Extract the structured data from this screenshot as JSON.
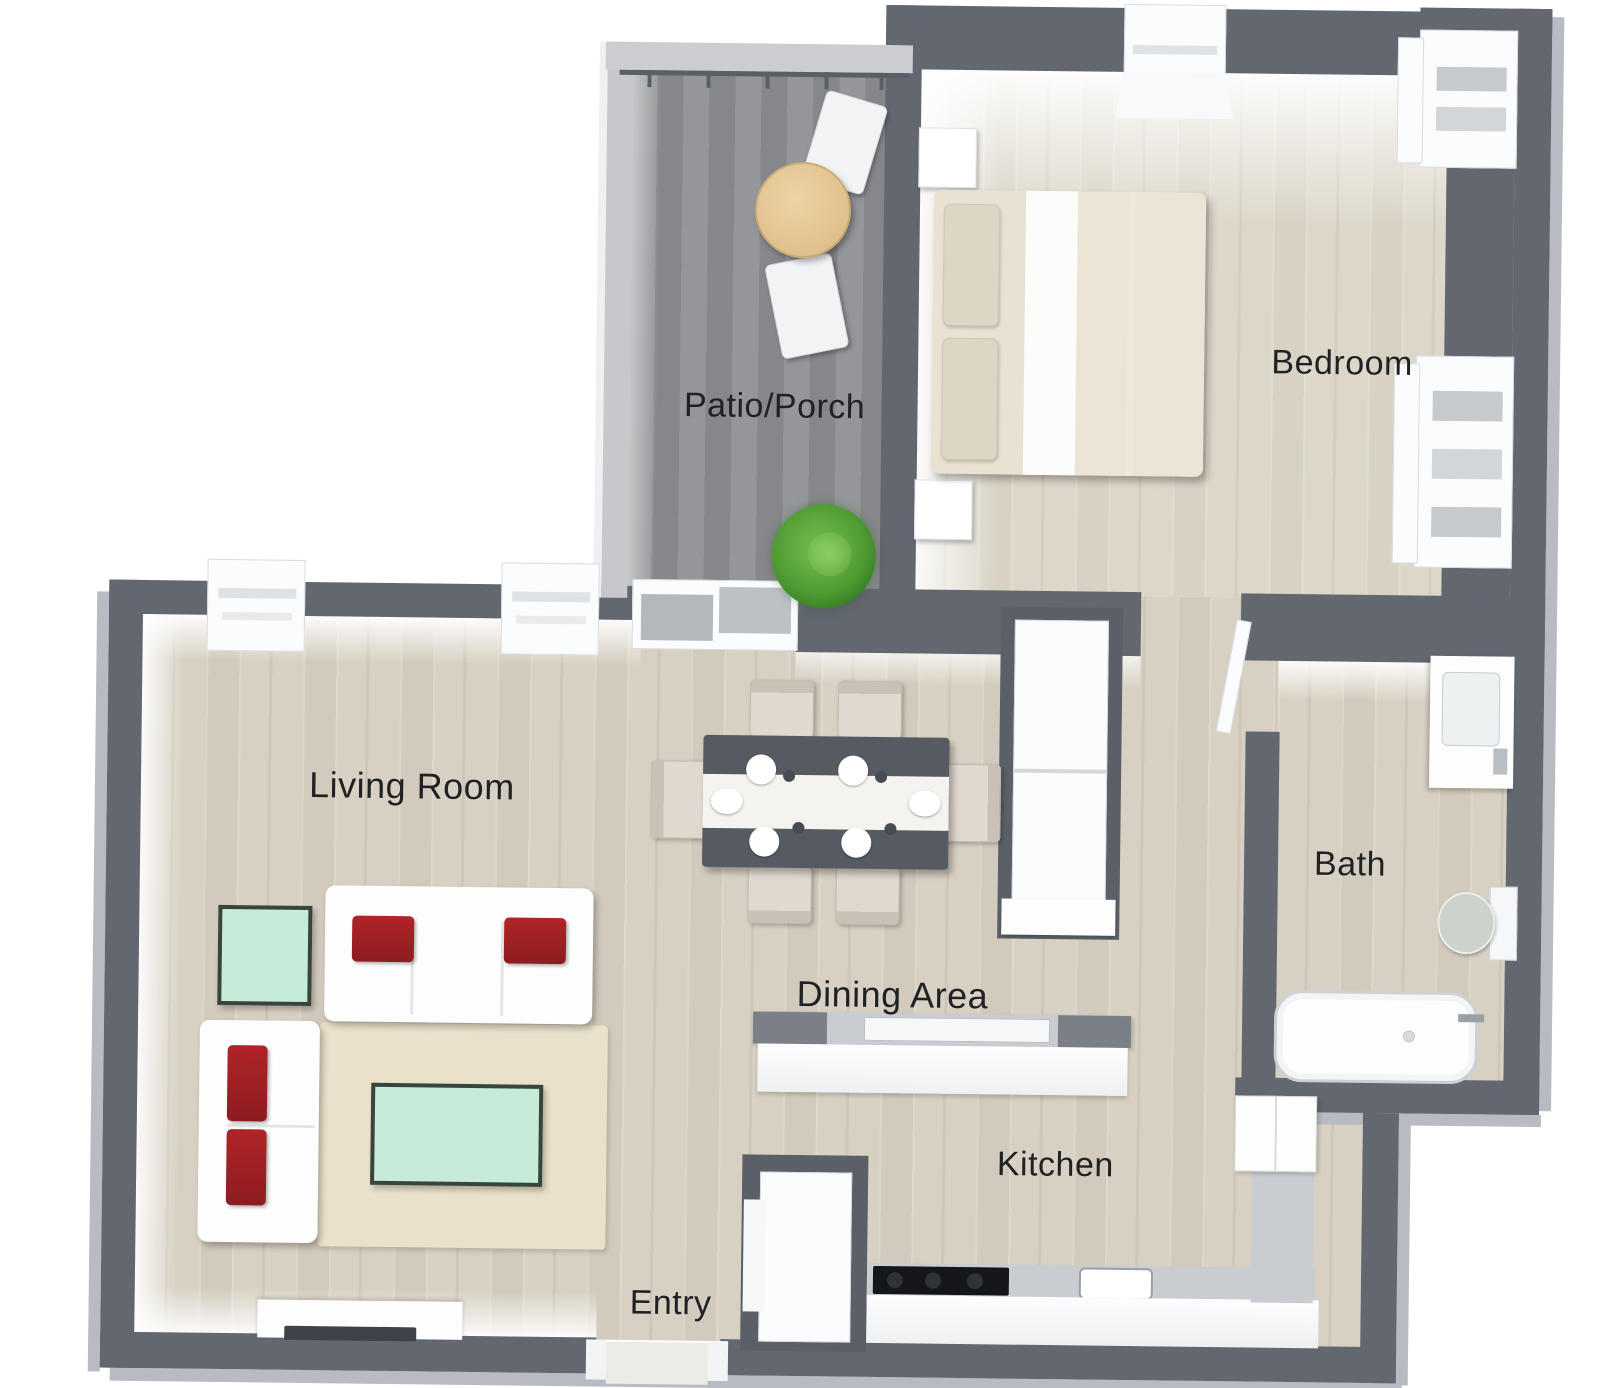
{
  "rooms": {
    "patio": {
      "label": "Patio/Porch"
    },
    "bedroom": {
      "label": "Bedroom"
    },
    "living": {
      "label": "Living Room"
    },
    "dining": {
      "label": "Dining Area"
    },
    "bath": {
      "label": "Bath"
    },
    "kitchen": {
      "label": "Kitchen"
    },
    "entry": {
      "label": "Entry"
    }
  },
  "colors": {
    "wall": "#626770",
    "foundation": "#b8bbc1",
    "wood_floor": "#d8d1c3",
    "patio_floor": "#8e8f93",
    "accent_red": "#a12226",
    "accent_mint": "#c6ebd9",
    "rug": "#e9e1ca",
    "plant_green": "#4f9c33",
    "table_wood": "#e8cd9e",
    "dining_table": "#565b62",
    "label_text": "#1f2124"
  }
}
